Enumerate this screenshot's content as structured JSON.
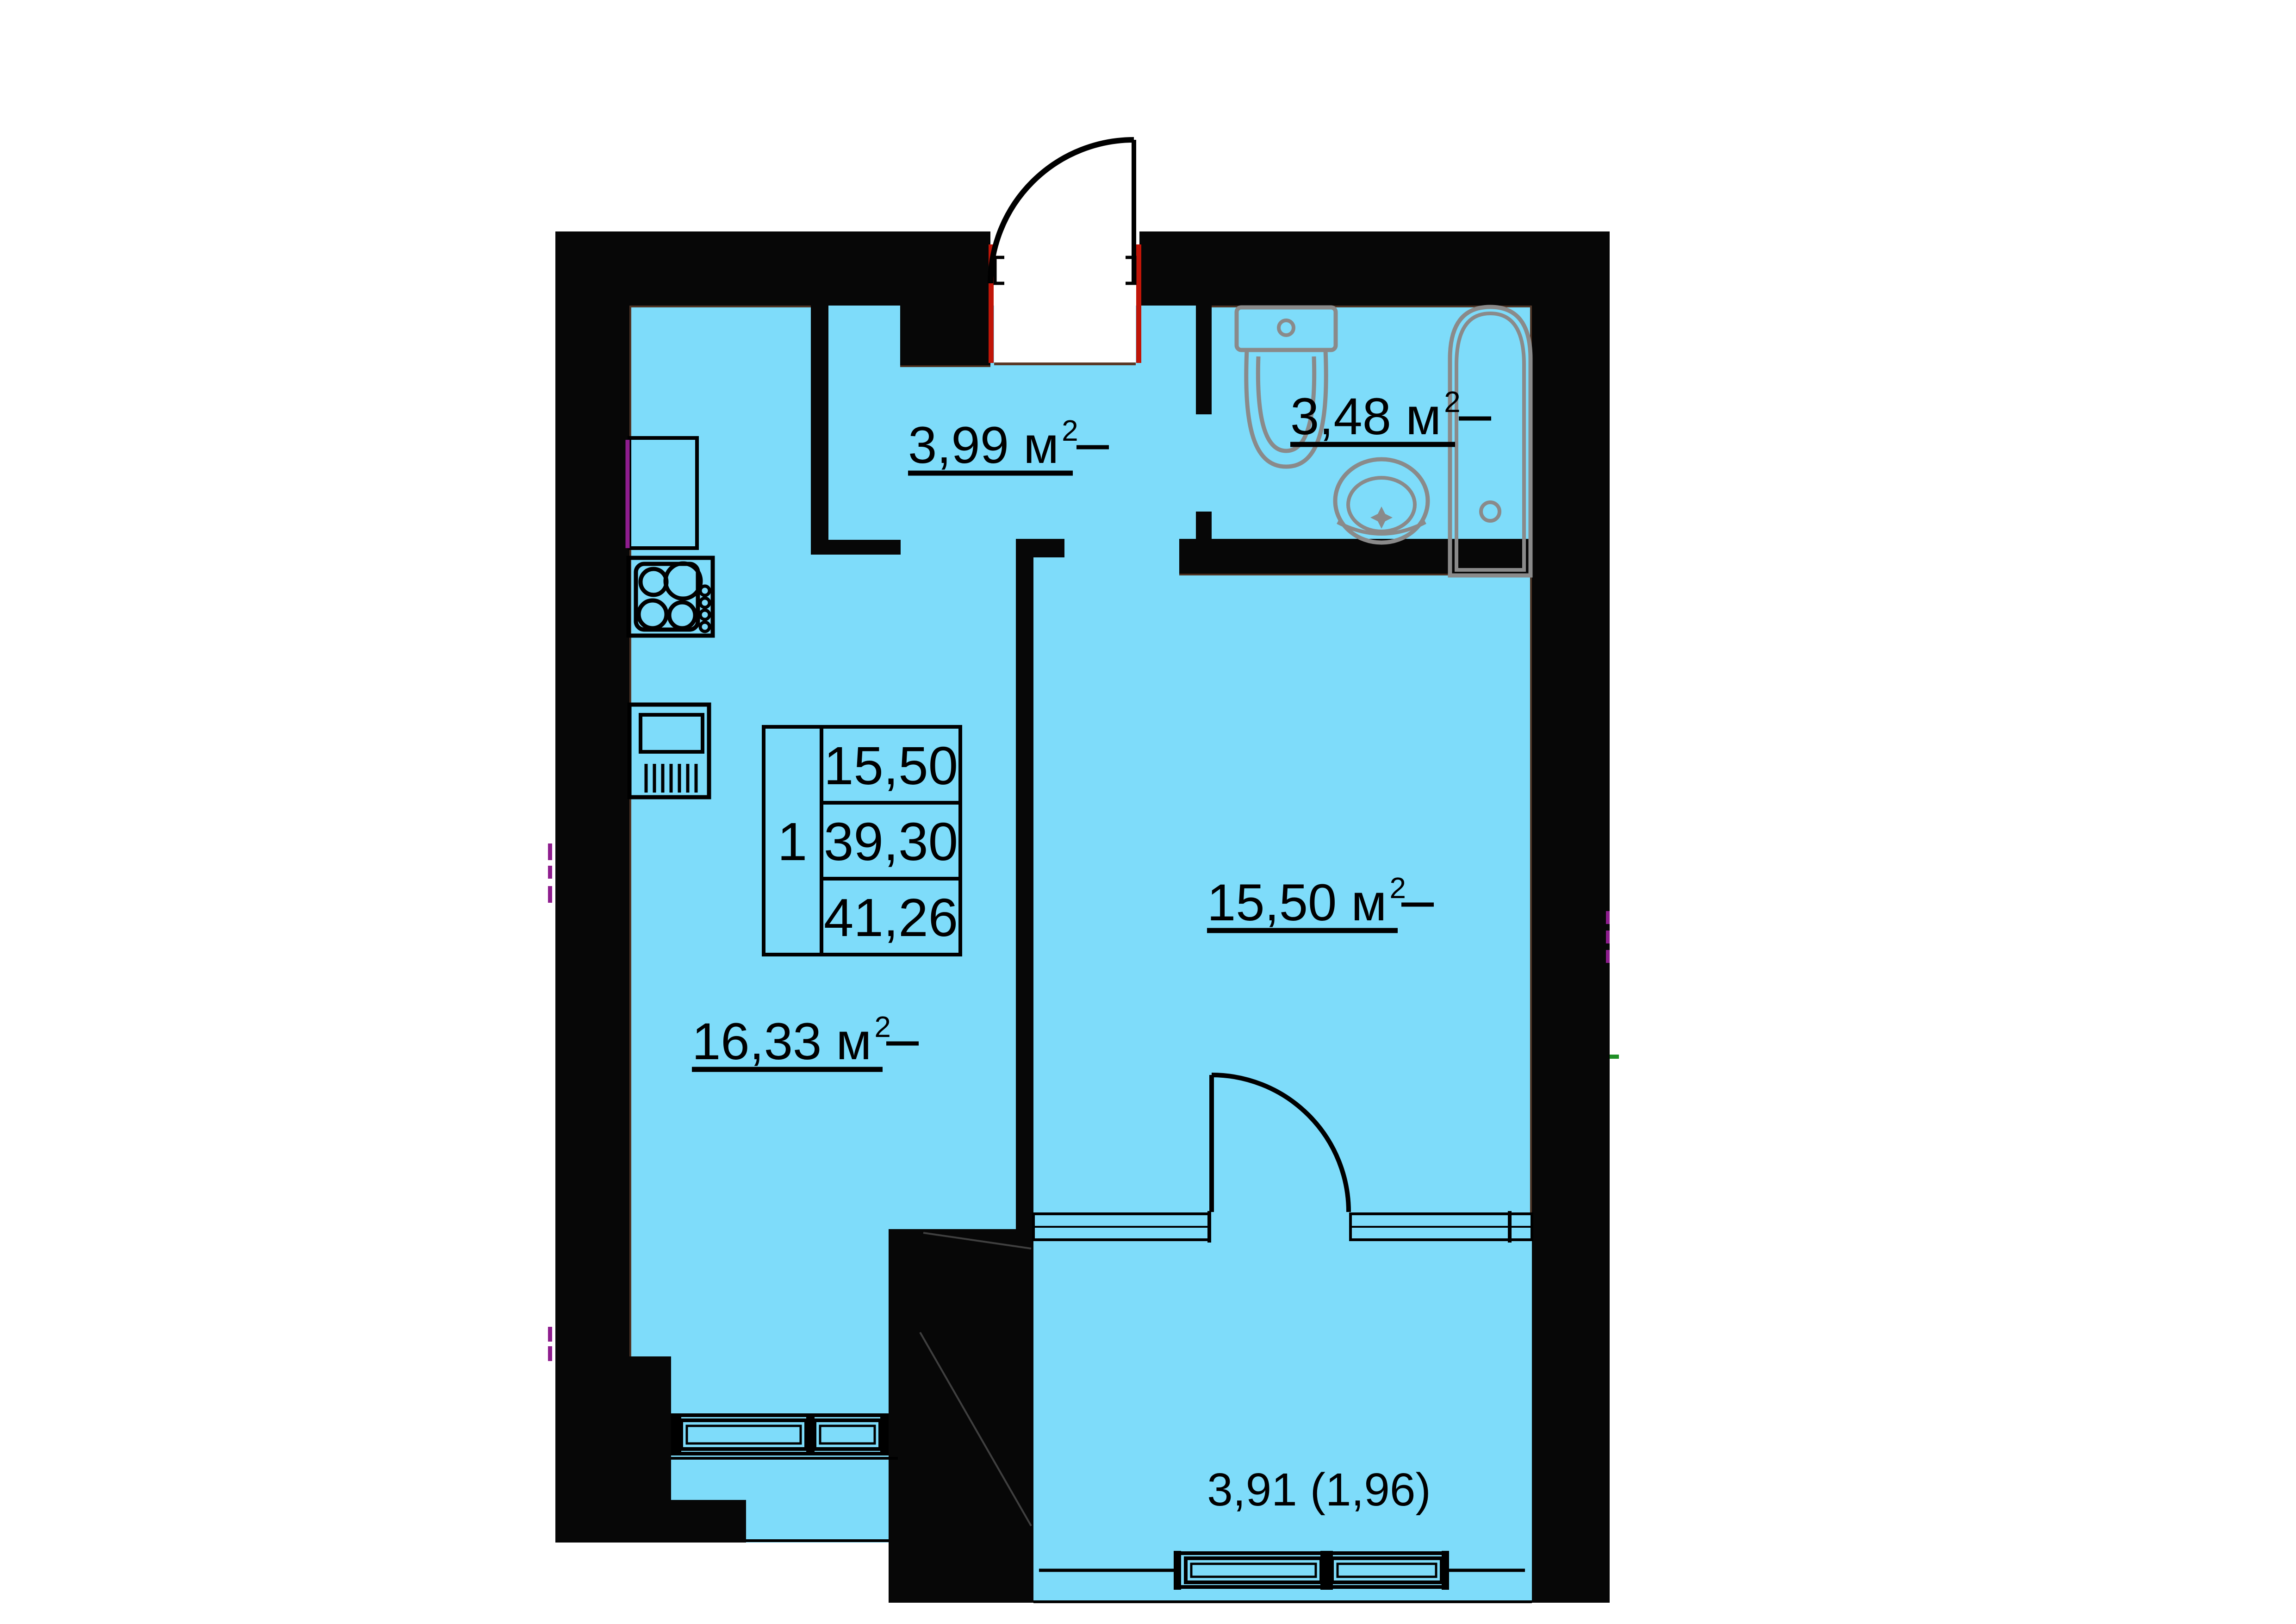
{
  "plan": {
    "type": "apartment-floor-plan",
    "rooms": {
      "hallway": {
        "label": "3,99 м",
        "sup": "2"
      },
      "bathroom": {
        "label": "3,48 м",
        "sup": "2"
      },
      "living": {
        "label": "15,50 м",
        "sup": "2"
      },
      "kitchen": {
        "label": "16,33 м",
        "sup": "2"
      },
      "balcony": {
        "label": "3,91 (1,96)"
      }
    },
    "stat_table": {
      "rooms_count": "1",
      "values": [
        "15,50",
        "39,30",
        "41,26"
      ]
    },
    "colors": {
      "floor": "#7edcfa",
      "wall": "#070707",
      "fixture": "#8a8a8a",
      "accent_red": "#c01508",
      "accent_purple": "#8e1d8e",
      "accent_green": "#1f8f25",
      "accent_brown": "#4a2410"
    }
  }
}
